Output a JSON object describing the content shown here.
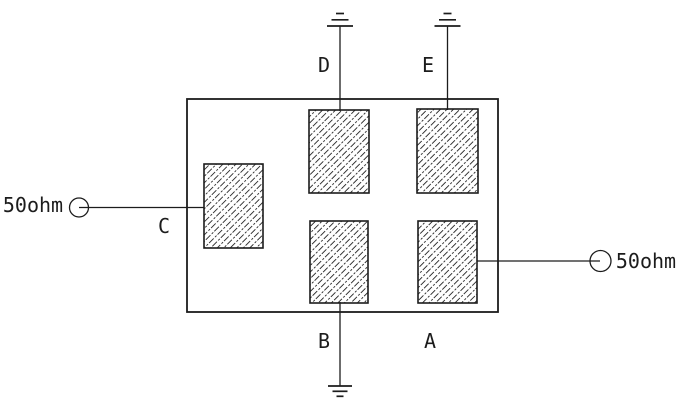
{
  "diagram": {
    "type": "schematic",
    "background_color": "#ffffff",
    "line_color": "#1c1c1c",
    "hatch_color": "#2e2e2e",
    "left_terminal": {
      "label": "50ohm",
      "icon": "port-circle-icon",
      "side": "left"
    },
    "right_terminal": {
      "label": "50ohm",
      "icon": "port-circle-icon",
      "side": "right"
    },
    "electrodes": {
      "C": {
        "label": "C",
        "connection": "left 50ohm port"
      },
      "D": {
        "label": "D",
        "connection": "ground"
      },
      "E": {
        "label": "E",
        "connection": "ground"
      },
      "B": {
        "label": "B",
        "connection": "ground"
      },
      "A": {
        "label": "A",
        "connection": "right 50ohm port"
      }
    },
    "ground_symbols": [
      "top-left above D",
      "top-right above E",
      "bottom below B"
    ]
  }
}
